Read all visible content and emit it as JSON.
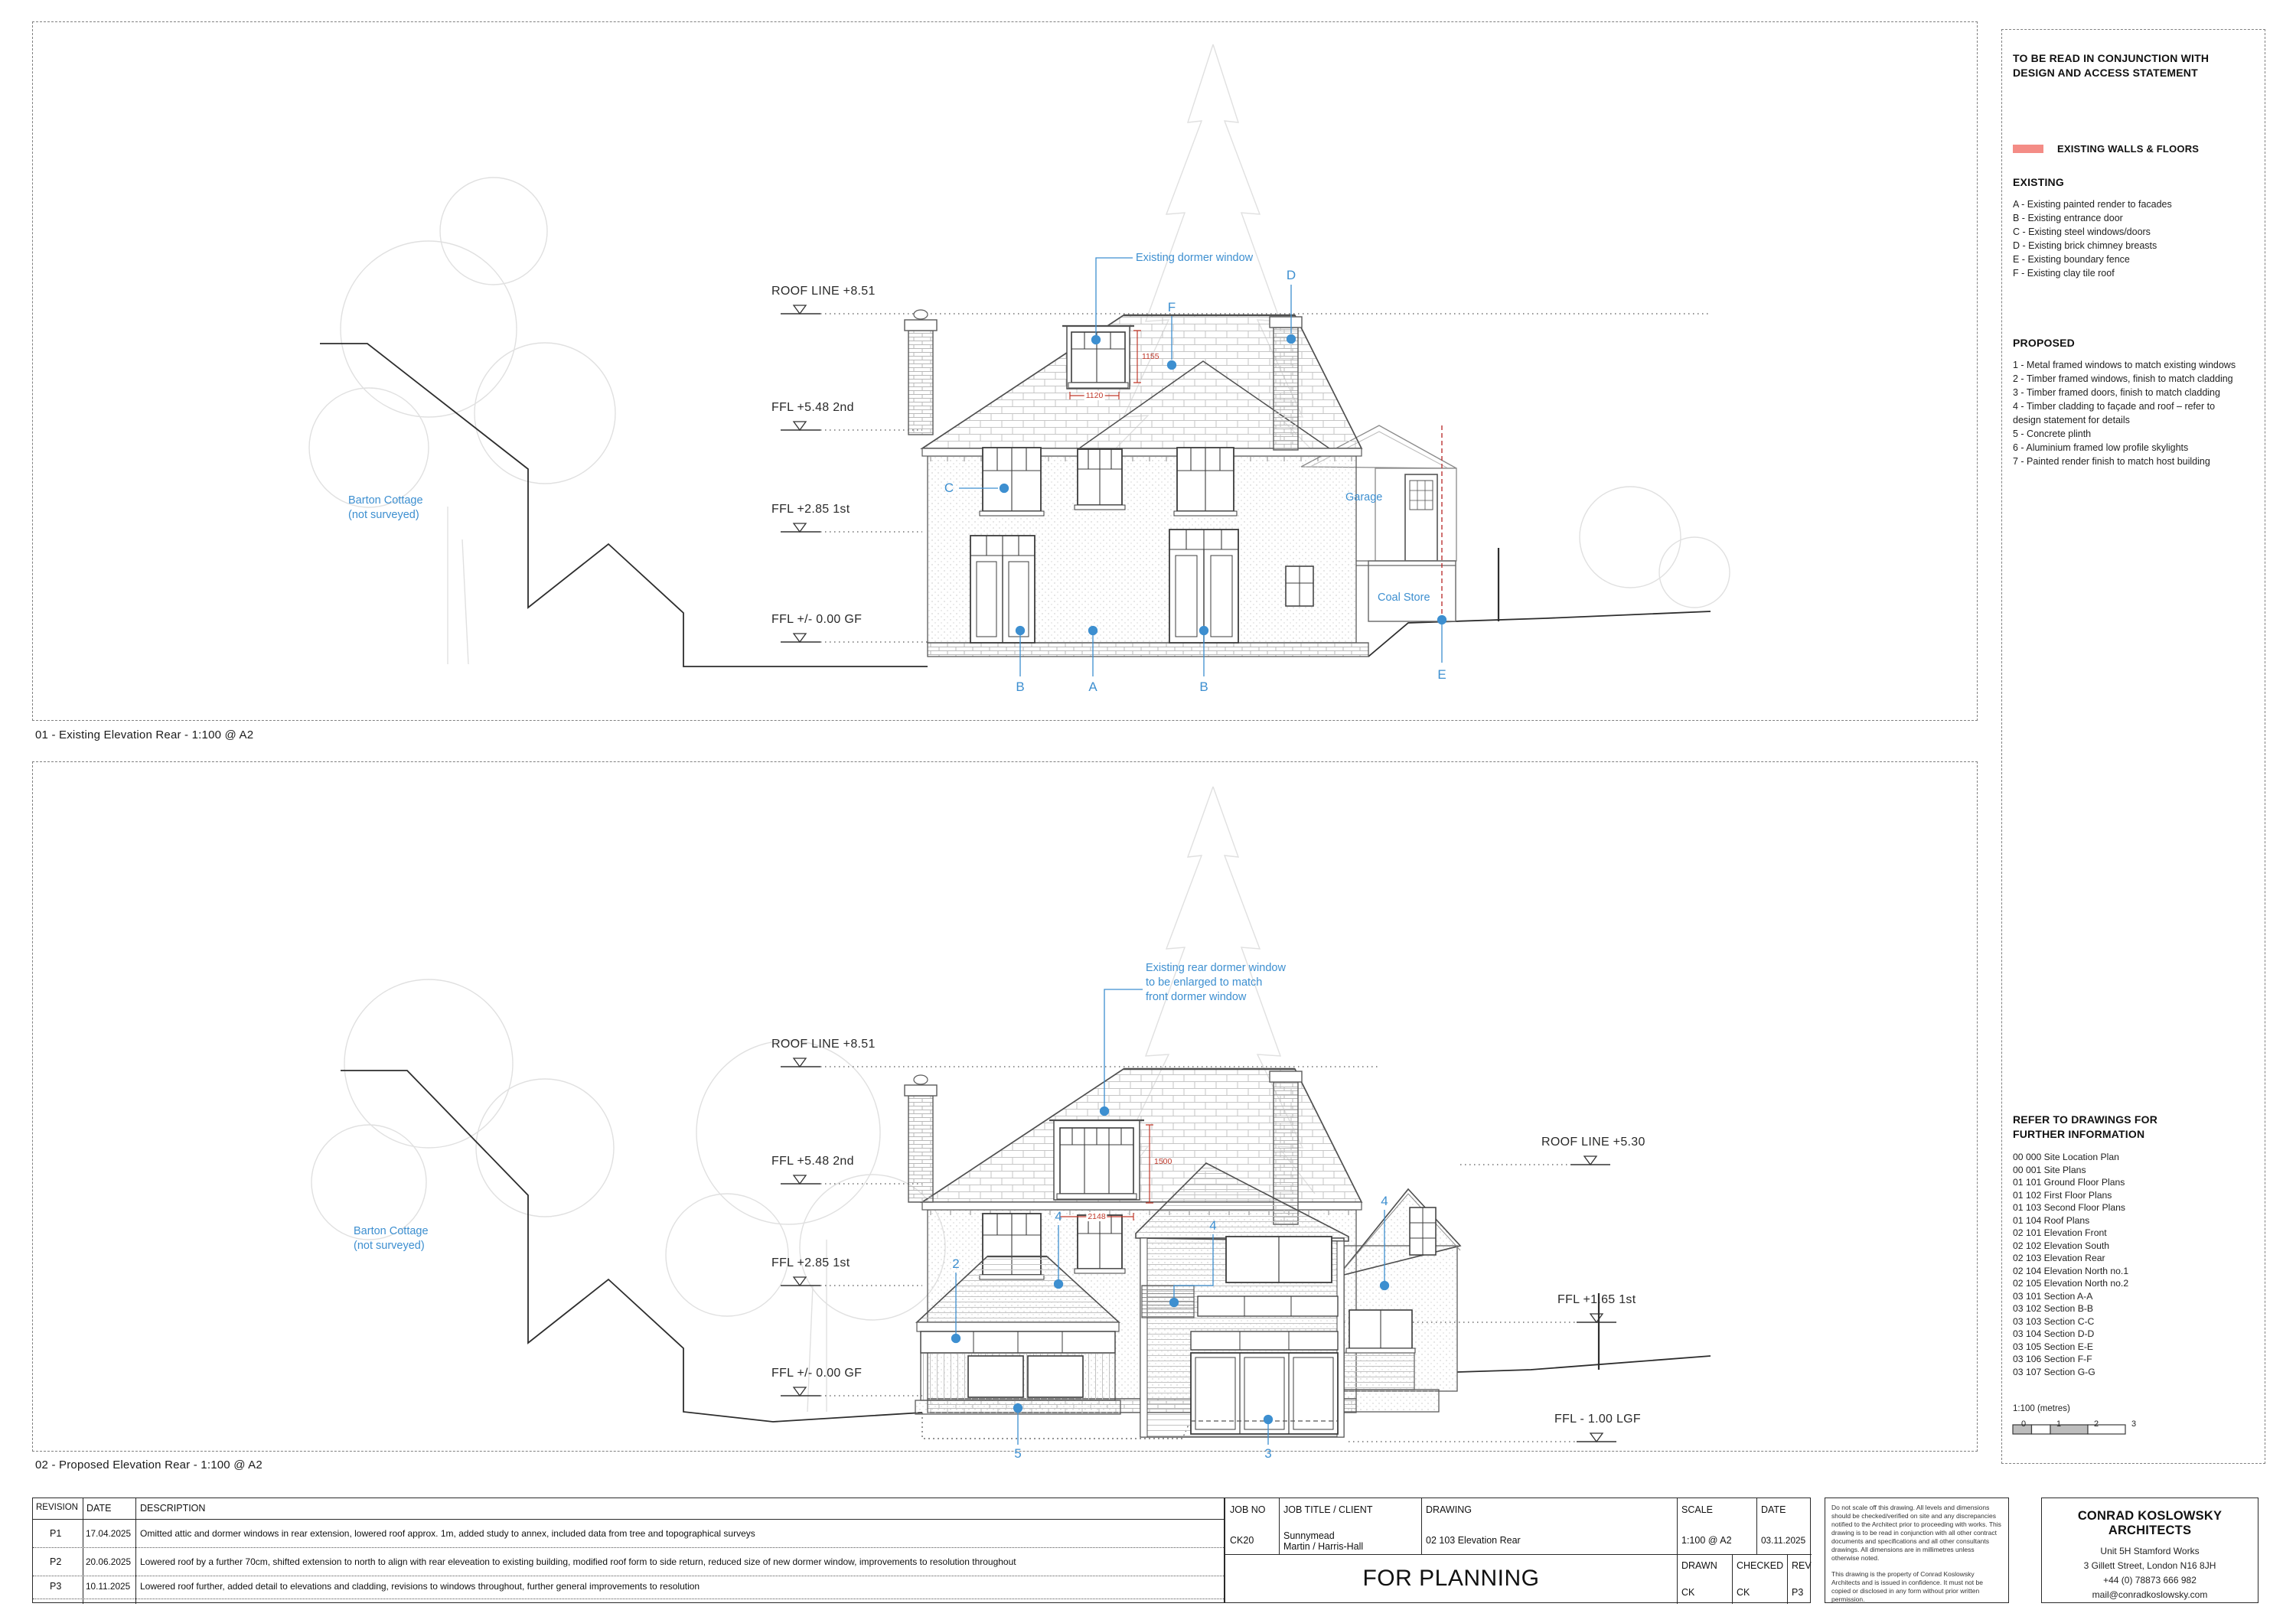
{
  "panel1": {
    "caption": "01 - Existing Elevation Rear - 1:100 @ A2",
    "levels": {
      "roof851": "ROOF LINE  +8.51",
      "ffl548": "FFL +5.48 2nd",
      "ffl285": "FFL +2.85 1st",
      "ffl000": "FFL +/- 0.00 GF"
    },
    "barton_line1": "Barton Cottage",
    "barton_line2": "(not surveyed)",
    "dormer_note": "Existing dormer window",
    "garage_label": "Garage",
    "coal_label": "Coal Store",
    "dims": {
      "v": "1155",
      "h": "1120"
    },
    "markers": {
      "a": "A",
      "b1": "B",
      "b2": "B",
      "c": "C",
      "d": "D",
      "e": "E",
      "f": "F"
    }
  },
  "panel2": {
    "caption": "02 - Proposed Elevation Rear - 1:100 @ A2",
    "levels": {
      "roof851": "ROOF LINE  +8.51",
      "ffl548": "FFL +5.48 2nd",
      "ffl285": "FFL +2.85 1st",
      "ffl000": "FFL +/- 0.00 GF",
      "roof530": "ROOF LINE  +5.30",
      "ffl165": "FFL +1.65 1st",
      "lgf100": "FFL - 1.00 LGF"
    },
    "barton_line1": "Barton Cottage",
    "barton_line2": "(not surveyed)",
    "dormer_note_line1": "Existing rear dormer window",
    "dormer_note_line2": "to be enlarged to match",
    "dormer_note_line3": "front dormer window",
    "dims": {
      "v": "1500",
      "h": "2148"
    },
    "markers": {
      "n2": "2",
      "n3": "3",
      "n4a": "4",
      "n4b": "4",
      "n4c": "4",
      "n5": "5"
    }
  },
  "sidebar": {
    "note_line1": "TO BE READ IN CONJUNCTION WITH",
    "note_line2": "DESIGN AND ACCESS STATEMENT",
    "legend": {
      "swatch_color": "#f48c86",
      "label": "EXISTING WALLS & FLOORS"
    },
    "existing_title": "EXISTING",
    "existing_items": [
      "A - Existing painted render to facades",
      "B - Existing entrance door",
      "C - Existing steel windows/doors",
      "D - Existing brick chimney breasts",
      "E - Existing boundary fence",
      "F - Existing clay tile roof"
    ],
    "proposed_title": "PROPOSED",
    "proposed_items": [
      "1 - Metal framed windows to match existing windows",
      "2 - Timber framed windows, finish to match cladding",
      "3 - Timber framed doors, finish to match cladding",
      "4 - Timber cladding to façade and roof – refer to design statement for details",
      "5 - Concrete plinth",
      "6 - Aluminium framed low profile skylights",
      "7 - Painted render finish to match host building"
    ],
    "refer_line1": "REFER TO DRAWINGS FOR",
    "refer_line2": "FURTHER INFORMATION",
    "drawings": [
      "00 000 Site Location Plan",
      "00 001 Site Plans",
      "01 101 Ground Floor Plans",
      "01 102 First Floor Plans",
      "01 103 Second Floor Plans",
      "01 104 Roof Plans",
      "02 101 Elevation Front",
      "02 102 Elevation South",
      "02 103 Elevation Rear",
      "02 104 Elevation North no.1",
      "02 105 Elevation North no.2",
      "03 101 Section A-A",
      "03 102 Section B-B",
      "03 103 Section C-C",
      "03 104 Section D-D",
      "03 105 Section E-E",
      "03 106 Section F-F",
      "03 107 Section G-G"
    ],
    "scale_label": "1:100 (metres)",
    "scale_ticks": [
      "0",
      "1",
      "2",
      "3"
    ]
  },
  "titleblock": {
    "headers": {
      "revision": "REVISION",
      "date": "DATE",
      "description": "DESCRIPTION"
    },
    "rows": [
      {
        "rev": "P1",
        "date": "17.04.2025",
        "desc": "Omitted attic and dormer windows in rear extension, lowered roof approx. 1m, added study to annex, included data from tree and topographical surveys"
      },
      {
        "rev": "P2",
        "date": "20.06.2025",
        "desc": "Lowered roof by a further 70cm, shifted extension to north to align with rear eleveation to existing building, modified roof form to side return, reduced size of new dormer window, improvements to resolution throughout"
      },
      {
        "rev": "P3",
        "date": "10.11.2025",
        "desc": "Lowered roof further, added detail to elevations and cladding, revisions to windows throughout, further general improvements to resolution"
      }
    ],
    "job_no": {
      "label": "JOB NO",
      "value": "CK20"
    },
    "job_title": {
      "label": "JOB TITLE / CLIENT",
      "line1": "Sunnymead",
      "line2": "Martin / Harris-Hall"
    },
    "drawing": {
      "label": "DRAWING",
      "value": "02 103 Elevation Rear"
    },
    "scale": {
      "label": "SCALE",
      "value": "1:100 @ A2"
    },
    "date": {
      "label": "DATE",
      "value": "03.11.2025"
    },
    "stamp": "FOR PLANNING",
    "drawn": {
      "label": "DRAWN",
      "value": "CK"
    },
    "checked": {
      "label": "CHECKED",
      "value": "CK"
    },
    "rev": {
      "label": "REV",
      "value": "P3"
    },
    "disclaimer_p1": "Do not scale off this drawing. All levels and dimensions should be checked/verified on site and any discrepancies notified to the Architect prior to proceeding with works. This drawing is to be read in conjunction with all other contract documents and specifications and all other consultants drawings. All dimensions are in millimetres unless otherwise noted.",
    "disclaimer_p2": "This drawing is the property of Conrad Koslowsky Architects and is issued in confidence. It must not be copied or disclosed in any form without prior written permission.",
    "firm": {
      "name": "CONRAD KOSLOWSKY ARCHITECTS",
      "addr1": "Unit 5H Stamford Works",
      "addr2": "3 Gillett Street, London N16 8JH",
      "addr3": "+44 (0) 78873 666 982",
      "addr4": "mail@conradkoslowsky.com"
    }
  }
}
